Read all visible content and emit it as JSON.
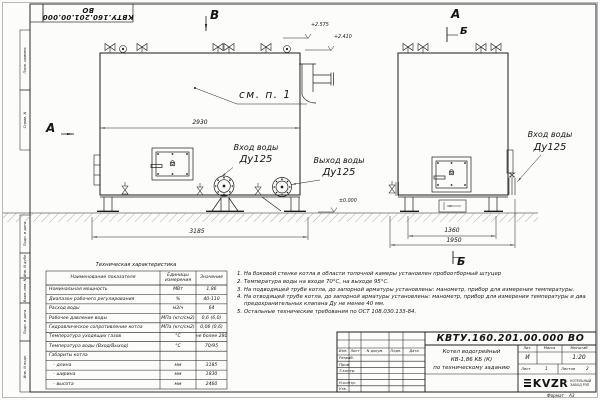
{
  "sheet": {
    "doc_number_top": "КВТУ.160.201.00.000 ВО",
    "format_label": "Формат",
    "format_value": "А3"
  },
  "frame_stamps": [
    "Перв. примен.",
    "Справ. N",
    "Подп. и дата",
    "Инв. N дубл.",
    "Взам. инв. N",
    "Подп. и дата",
    "Инв. N подл."
  ],
  "drawing": {
    "marker_v": "В",
    "marker_a_top": "А",
    "marker_b_top": "Б",
    "marker_a_left": "А",
    "marker_b_bottom": "Б",
    "see_item": "см. п. 1",
    "elev_2575": "+2.575",
    "elev_2410": "+2.410",
    "elev_zero": "±0.000",
    "dim_width_front": "2930",
    "dim_length_front": "3185",
    "dim_1360": "1360",
    "dim_1950": "1950",
    "inlet_line1": "Вход воды",
    "inlet_line2": "Ду125",
    "outlet_line1": "Выход воды",
    "outlet_line2": "Ду125",
    "side_inlet_line1": "Вход воды",
    "side_inlet_line2": "Ду125"
  },
  "spec_table": {
    "title": "Техническая характеристика",
    "col_name": "Наименование показателя",
    "col_units": "Единицы измерения",
    "col_value": "Значение",
    "rows": [
      {
        "name": "Номинальная мощность",
        "units": "МВт",
        "value": "1,86"
      },
      {
        "name": "Диапазон рабочего регулирования",
        "units": "%",
        "value": "40-110"
      },
      {
        "name": "Расход воды",
        "units": "м3/ч",
        "value": "64"
      },
      {
        "name": "Рабочее давление воды",
        "units": "МПа (кгс/см2)",
        "value": "0,6 (6,0)"
      },
      {
        "name": "Гидравлическое сопротивление котла",
        "units": "МПа (кгс/см2)",
        "value": "0,06 (0,6)"
      },
      {
        "name": "Температура уходящих газов",
        "units": "°С",
        "value": "не более 280"
      },
      {
        "name": "Температура воды (Вход/Выход)",
        "units": "°С",
        "value": "70/95"
      },
      {
        "name": "Габариты котла",
        "units": "",
        "value": ""
      },
      {
        "name": "   - длина",
        "units": "мм",
        "value": "3185"
      },
      {
        "name": "   - ширина",
        "units": "мм",
        "value": "1830"
      },
      {
        "name": "   - высота",
        "units": "мм",
        "value": "2460"
      }
    ]
  },
  "notes": [
    "1.  На боковой стенке котла в области топочной камеры установлен пробоотборный штуцер",
    "2.  Температура воды на входе 70°С, на выходе 95°С.",
    "3.  На подводящей трубе котла, до запорной арматуры установлены: манометр, прибор для измерения температуры.",
    "4.  На отводящей трубе котла, до запорной арматуры установлены: манометр, прибор для измерения температуры и два предохранительных клапана Ду не менее 40 мм.",
    "5.  Остальные технические требования по ОСТ 108.030.133-84."
  ],
  "title_block": {
    "doc_number": "КВТУ.160.201.00.000 ВО",
    "col_izm": "Изм.",
    "col_list": "Лист",
    "col_ndoc": "N докум.",
    "col_podp": "Подп.",
    "col_data": "Дата",
    "sig_razrab": "Разраб.",
    "sig_prov": "Пров.",
    "sig_tkontr": "Т.контр.",
    "sig_nkontr": "Н.контр.",
    "sig_utv": "Утв.",
    "product_title_1": "Котел водогрейный",
    "product_title_2": "КВ-1,86 КБ (К)",
    "product_title_3": "по техническому заданию",
    "lit_header": "Лит.",
    "mass_header": "Масса",
    "scale_header": "Масштаб",
    "lit_value": "И",
    "scale_value": "1:20",
    "sheet_label": "Лист",
    "sheet_value": "1",
    "sheets_label": "Листов",
    "sheets_value": "2",
    "logo_text": "KVZR",
    "logo_sub_1": "КОТЕЛЬНЫЙ",
    "logo_sub_2": "ЗАВОД РЭП"
  }
}
